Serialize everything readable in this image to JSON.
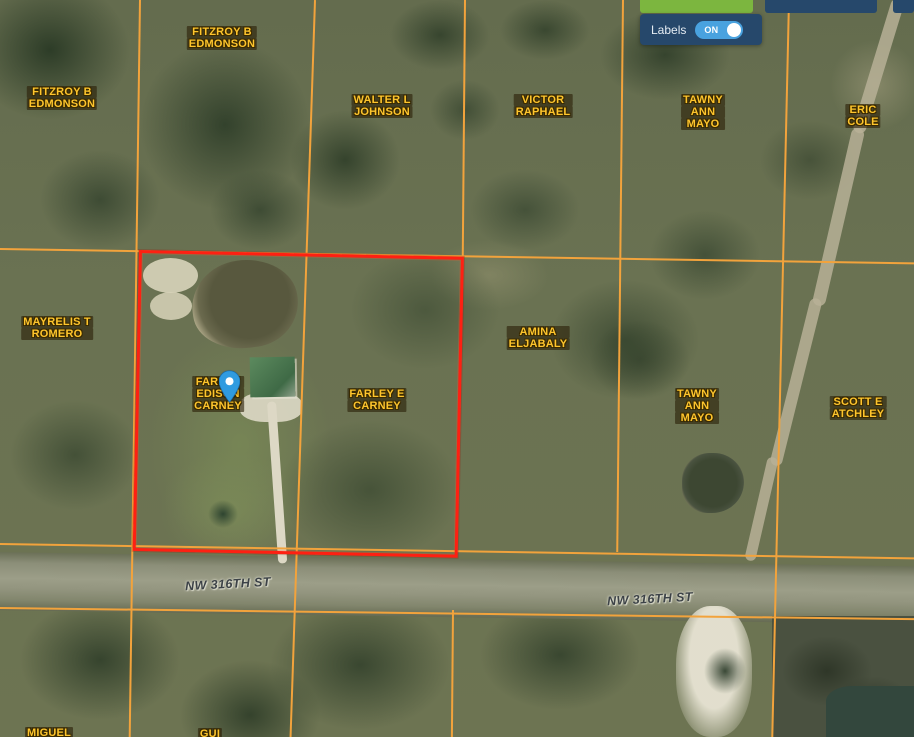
{
  "toolbar": {
    "labels_toggle": {
      "label": "Labels",
      "state": "ON"
    }
  },
  "map": {
    "parcel_labels": [
      {
        "name": "FITZROY B EDMONSON",
        "lines": [
          "FITZROY B",
          "EDMONSON"
        ],
        "x": 222,
        "y": 26
      },
      {
        "name": "FITZROY B EDMONSON",
        "lines": [
          "FITZROY B",
          "EDMONSON"
        ],
        "x": 62,
        "y": 86
      },
      {
        "name": "WALTER L JOHNSON",
        "lines": [
          "WALTER L",
          "JOHNSON"
        ],
        "x": 382,
        "y": 94
      },
      {
        "name": "VICTOR RAPHAEL",
        "lines": [
          "VICTOR",
          "RAPHAEL"
        ],
        "x": 543,
        "y": 94
      },
      {
        "name": "TAWNY ANN MAYO",
        "lines": [
          "TAWNY",
          "ANN",
          "MAYO"
        ],
        "x": 703,
        "y": 94
      },
      {
        "name": "ERIC COLE",
        "lines": [
          "ERIC",
          "COLE"
        ],
        "x": 863,
        "y": 104
      },
      {
        "name": "MAYRELIS T ROMERO",
        "lines": [
          "MAYRELIS T",
          "ROMERO"
        ],
        "x": 57,
        "y": 316
      },
      {
        "name": "AMINA ELJABALY",
        "lines": [
          "AMINA",
          "ELJABALY"
        ],
        "x": 538,
        "y": 326
      },
      {
        "name": "FARLEY EDISON CARNEY",
        "lines": [
          "FARLEY",
          "EDISON",
          "CARNEY"
        ],
        "x": 218,
        "y": 376
      },
      {
        "name": "FARLEY E CARNEY",
        "lines": [
          "FARLEY E",
          "CARNEY"
        ],
        "x": 377,
        "y": 388
      },
      {
        "name": "TAWNY ANN MAYO",
        "lines": [
          "TAWNY",
          "ANN",
          "MAYO"
        ],
        "x": 697,
        "y": 388
      },
      {
        "name": "SCOTT E ATCHLEY",
        "lines": [
          "SCOTT E",
          "ATCHLEY"
        ],
        "x": 858,
        "y": 396
      },
      {
        "name": "MIGUEL (cut off)",
        "lines": [
          "MIGUEL"
        ],
        "x": 49,
        "y": 727
      },
      {
        "name": "GUI (cut off)",
        "lines": [
          "GUI"
        ],
        "x": 210,
        "y": 728
      }
    ],
    "street_labels": [
      {
        "text": "NW 316TH ST",
        "x": 228,
        "y": 584,
        "angle": -3
      },
      {
        "text": "NW 316TH ST",
        "x": 650,
        "y": 599,
        "angle": -3
      }
    ],
    "colors": {
      "selected_parcel": "#fe2012",
      "parcel_line": "#f2a33c",
      "owner_label": "#fec52d",
      "marker": "#2f9be0",
      "panel": "#26486b",
      "toggle_on": "#49a2df",
      "green_button": "#7cb63f"
    }
  }
}
